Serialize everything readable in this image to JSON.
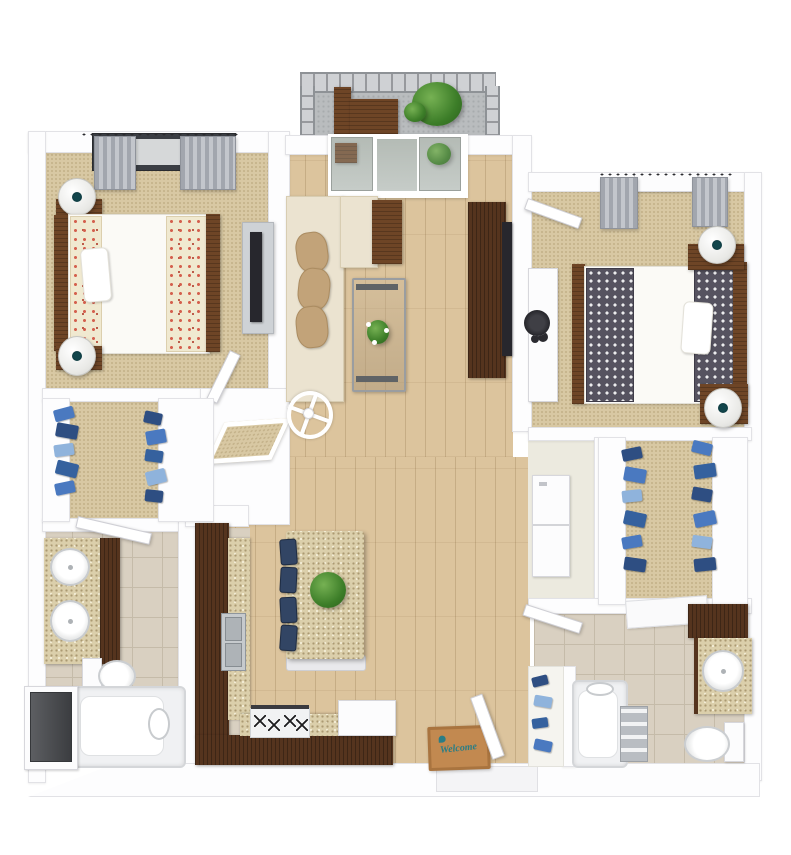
{
  "floor_plan": {
    "type": "3d-apartment-floor-plan-top-view",
    "entry": {
      "mat_text": "Welcome",
      "mat_icon": "bird-icon"
    },
    "rooms": [
      {
        "name": "bedroom-left",
        "floor": "carpet",
        "furniture": [
          "queen-bed-floral-bedding",
          "nightstand",
          "nightstand",
          "table-lamp",
          "table-lamp",
          "dresser",
          "tv",
          "window-with-curtains",
          "door"
        ]
      },
      {
        "name": "living-room",
        "floor": "hardwood",
        "furniture": [
          "l-sectional-sofa",
          "accent-pillows",
          "side-table",
          "coffee-table-with-flowers",
          "tv-console",
          "tv",
          "ceiling-fan",
          "sliding-glass-door"
        ]
      },
      {
        "name": "balcony",
        "floor": "concrete",
        "furniture": [
          "railing",
          "wood-chairs",
          "potted-plant"
        ]
      },
      {
        "name": "bedroom-right",
        "floor": "carpet",
        "furniture": [
          "queen-bed-ikat-bedding",
          "nightstand",
          "nightstand",
          "table-lamp",
          "table-lamp",
          "desk",
          "desk-chair",
          "window-with-curtains",
          "door"
        ]
      },
      {
        "name": "walk-in-closet-left",
        "floor": "carpet",
        "furniture": [
          "hanging-clothes-left-rail",
          "hanging-clothes-right-rail",
          "shelving"
        ]
      },
      {
        "name": "bathroom-left",
        "floor": "tile",
        "furniture": [
          "double-vanity",
          "two-oval-sinks",
          "toilet",
          "bathtub",
          "door",
          "utility-closet-dark"
        ]
      },
      {
        "name": "kitchen",
        "floor": "hardwood",
        "furniture": [
          "l-shaped-cabinets",
          "granite-counters",
          "double-sink",
          "stove-4-burners",
          "dishwasher",
          "island-with-plant",
          "bar-stools-x4",
          "pantry"
        ]
      },
      {
        "name": "entry",
        "floor": "hardwood",
        "furniture": [
          "welcome-mat",
          "front-door"
        ]
      },
      {
        "name": "laundry-closet",
        "floor": "vinyl",
        "furniture": [
          "stacked-washer-dryer"
        ]
      },
      {
        "name": "walk-in-closet-right",
        "floor": "carpet",
        "furniture": [
          "hanging-clothes-left-rail",
          "hanging-clothes-right-rail",
          "shelving"
        ]
      },
      {
        "name": "bathroom-right",
        "floor": "tile",
        "furniture": [
          "vanity-with-round-sink",
          "upper-cabinet",
          "toilet",
          "bathtub",
          "towel-shelf",
          "shoe-closet",
          "bath-rug",
          "door"
        ]
      }
    ]
  },
  "palette": {
    "wall": "#fdfdfe",
    "wall_edge": "#e2e2e6",
    "carpet": "#d8c8a3",
    "carpet_dot": "#c3b189",
    "wood": "#dcc49d",
    "tile": "#d9d0c1",
    "tile_line": "#c5bba9",
    "granite": "#dbcfab",
    "granite_dot": "#ab9a72",
    "cabinet": "#55341e",
    "wood_table": "#6e4526",
    "sofa": "#ebe3d0",
    "sofa_edge": "#d8cdb2",
    "pillow": "#c2a379",
    "floral_base": "#f0e9d0",
    "floral_red": "#d4604e",
    "ikat_base": "#565360",
    "ikat_pink": "#c2487e",
    "curtain": "#a2a6ae",
    "window_dark": "#3b3e44",
    "navy": "#324564",
    "plant": "#4c9137",
    "mat": "#c28950",
    "mat_teal": "#2a7d85",
    "towel": "#b9bdc2",
    "dark_closet": "#46484c",
    "gray_furn": "#ced2d6",
    "tv": "#27272d"
  }
}
